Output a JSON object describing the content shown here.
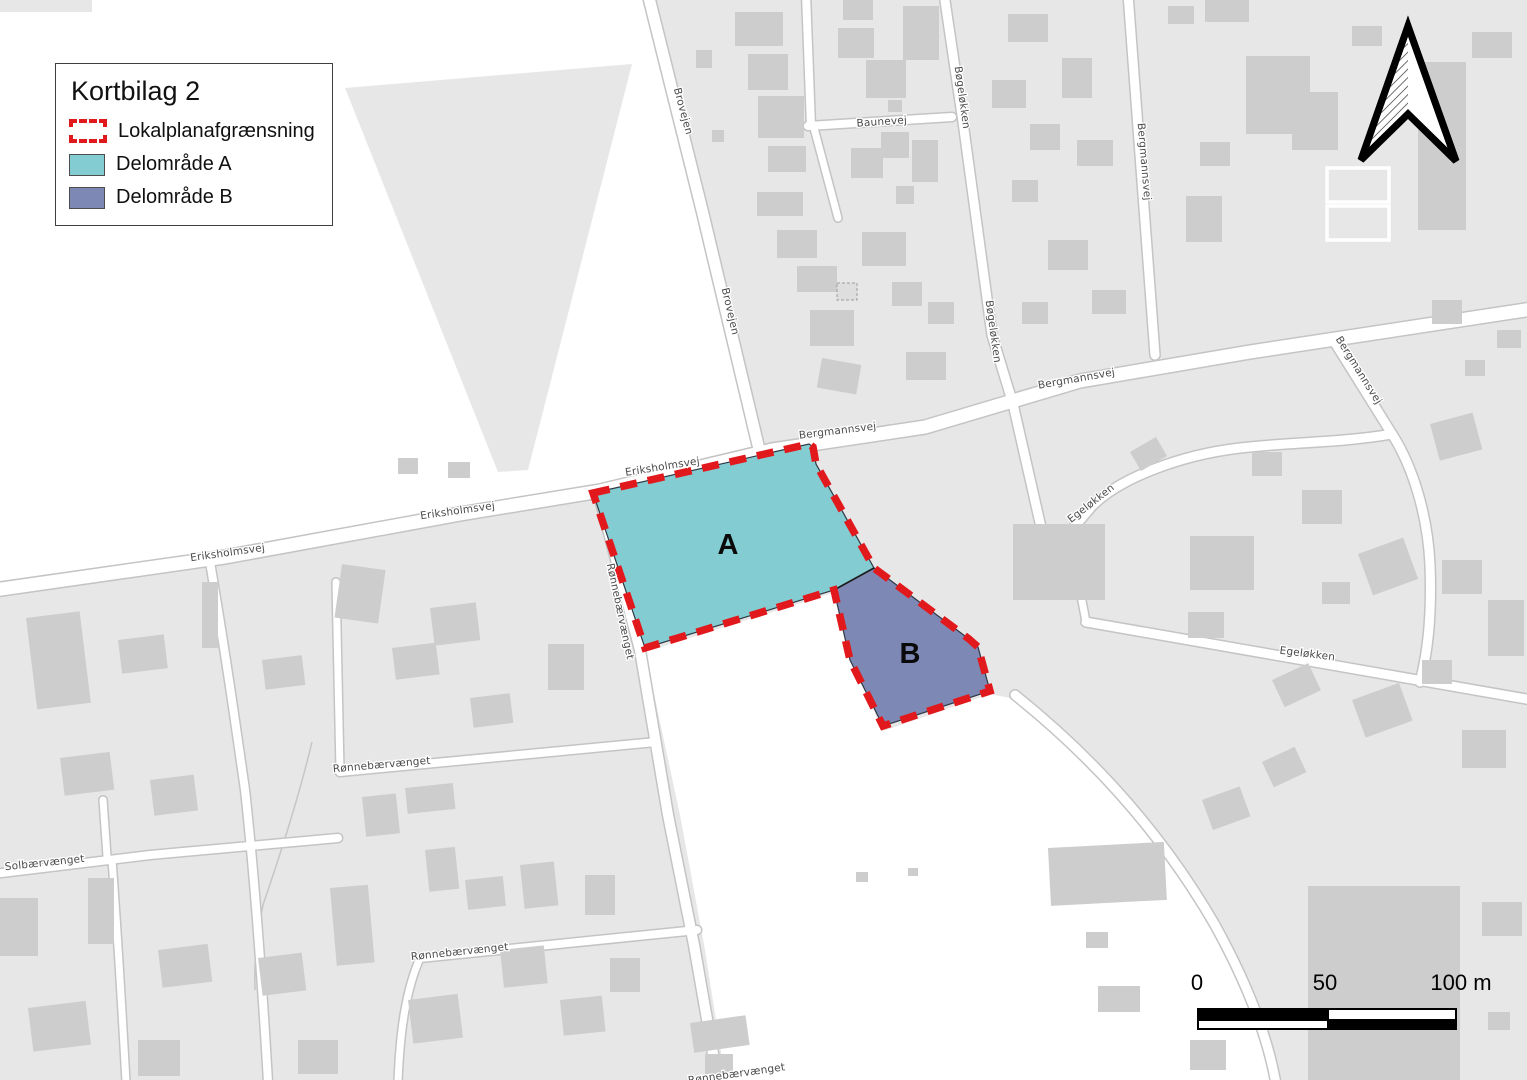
{
  "map_title": "Kortbilag 2",
  "legend": {
    "title": "Kortbilag 2",
    "items": [
      {
        "label": "Lokalplanafgrænsning",
        "type": "dashed-outline",
        "color": "#e2191c"
      },
      {
        "label": "Delområde A",
        "type": "fill",
        "color": "#83ccd2"
      },
      {
        "label": "Delområde B",
        "type": "fill",
        "color": "#7d88b4"
      }
    ]
  },
  "regions": [
    {
      "id": "A",
      "label": "A",
      "color": "#83ccd2",
      "label_x": 728,
      "label_y": 554
    },
    {
      "id": "B",
      "label": "B",
      "color": "#7d88b4",
      "label_x": 910,
      "label_y": 663
    }
  ],
  "street_labels": [
    {
      "text": "Brovejen",
      "x": 680,
      "y": 112,
      "rotation": 75
    },
    {
      "text": "Brovejen",
      "x": 727,
      "y": 312,
      "rotation": 77
    },
    {
      "text": "Baunevej",
      "x": 882,
      "y": 125,
      "rotation": -4
    },
    {
      "text": "Bøgeløkken",
      "x": 959,
      "y": 98,
      "rotation": 82
    },
    {
      "text": "Bøgeløkken",
      "x": 990,
      "y": 332,
      "rotation": 82
    },
    {
      "text": "Bergmannsvej",
      "x": 1141,
      "y": 162,
      "rotation": 85
    },
    {
      "text": "Bergmannsvej",
      "x": 838,
      "y": 434,
      "rotation": -7
    },
    {
      "text": "Bergmannsvej",
      "x": 1077,
      "y": 382,
      "rotation": -10
    },
    {
      "text": "Bergmannsvej",
      "x": 1356,
      "y": 372,
      "rotation": 58
    },
    {
      "text": "Eriksholmsvej",
      "x": 228,
      "y": 556,
      "rotation": -8
    },
    {
      "text": "Eriksholmsvej",
      "x": 458,
      "y": 514,
      "rotation": -8
    },
    {
      "text": "Eriksholmsvej",
      "x": 663,
      "y": 470,
      "rotation": -9
    },
    {
      "text": "Rønnebærvænget",
      "x": 617,
      "y": 612,
      "rotation": 78
    },
    {
      "text": "Rønnebærvænget",
      "x": 382,
      "y": 768,
      "rotation": -5
    },
    {
      "text": "Rønnebærvænget",
      "x": 460,
      "y": 955,
      "rotation": -6
    },
    {
      "text": "Rønnebærvænget",
      "x": 737,
      "y": 1077,
      "rotation": -8
    },
    {
      "text": "Solbærvænget",
      "x": 45,
      "y": 866,
      "rotation": -6
    },
    {
      "text": "Egeløkken",
      "x": 1093,
      "y": 506,
      "rotation": -38
    },
    {
      "text": "Egeløkken",
      "x": 1307,
      "y": 657,
      "rotation": 7
    }
  ],
  "scale_bar": {
    "labels": [
      "0",
      "50",
      "100 m"
    ]
  },
  "north_arrow": {
    "description": "north-arrow"
  },
  "map_colors": {
    "boundary": "#e2191c",
    "area_a": "#83ccd2",
    "area_b": "#7d88b4",
    "parcel": "#e7e7e7",
    "building": "#cdcdcd",
    "road": "#ffffff"
  }
}
